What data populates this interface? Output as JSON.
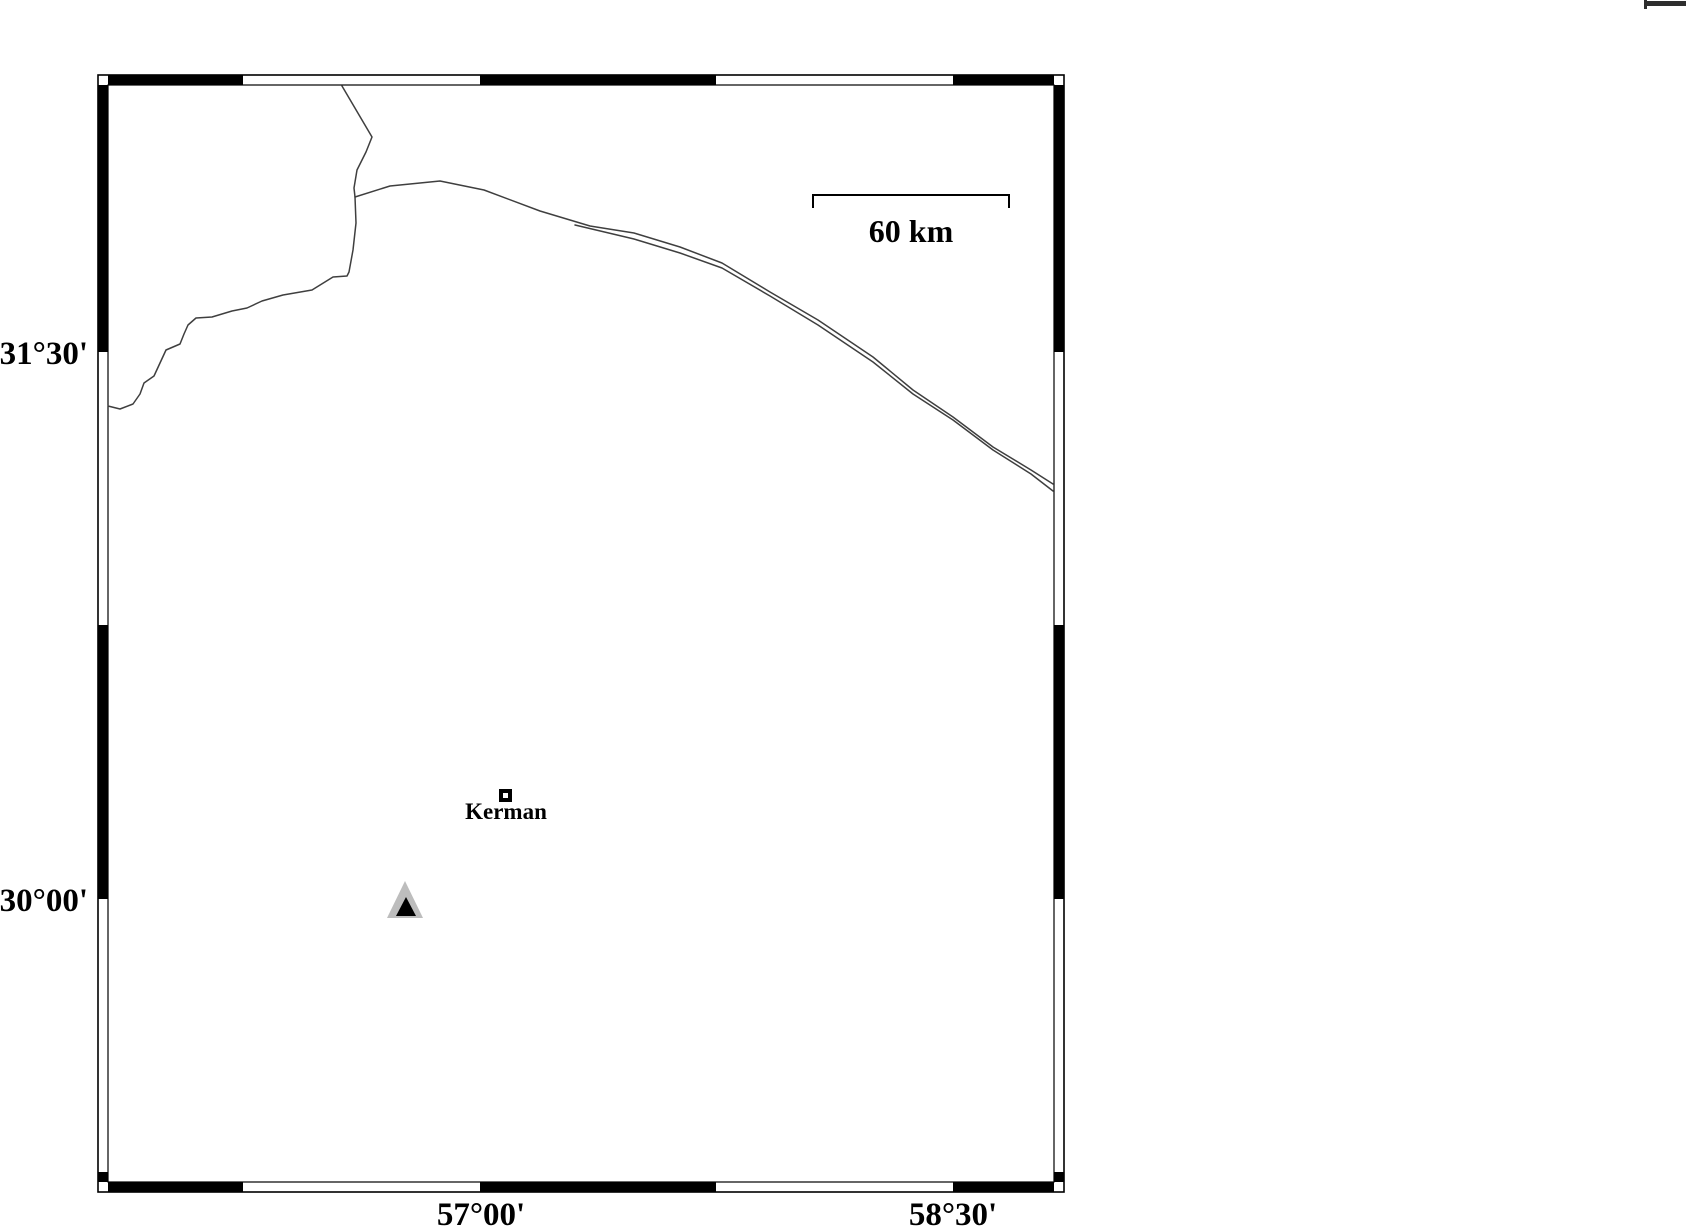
{
  "figure": {
    "type": "map",
    "description": "Black-and-white location map with fancy GMT-style graticule frame",
    "graticule": {
      "lat_ticks": [
        {
          "label": "31°30'"
        },
        {
          "label": "30°00'"
        }
      ],
      "lon_ticks": [
        {
          "label": "57°00'"
        },
        {
          "label": "58°30'"
        }
      ]
    },
    "scale_bar": {
      "label": "60 km"
    },
    "city": {
      "name": "Kerman",
      "marker": "open-square"
    },
    "station": {
      "marker": "filled-triangle"
    },
    "colors": {
      "frame": "#000000",
      "road": "#3f3f3f",
      "triangle_fill": "#bdbdbd",
      "triangle_core": "#000000",
      "background": "#ffffff"
    }
  }
}
